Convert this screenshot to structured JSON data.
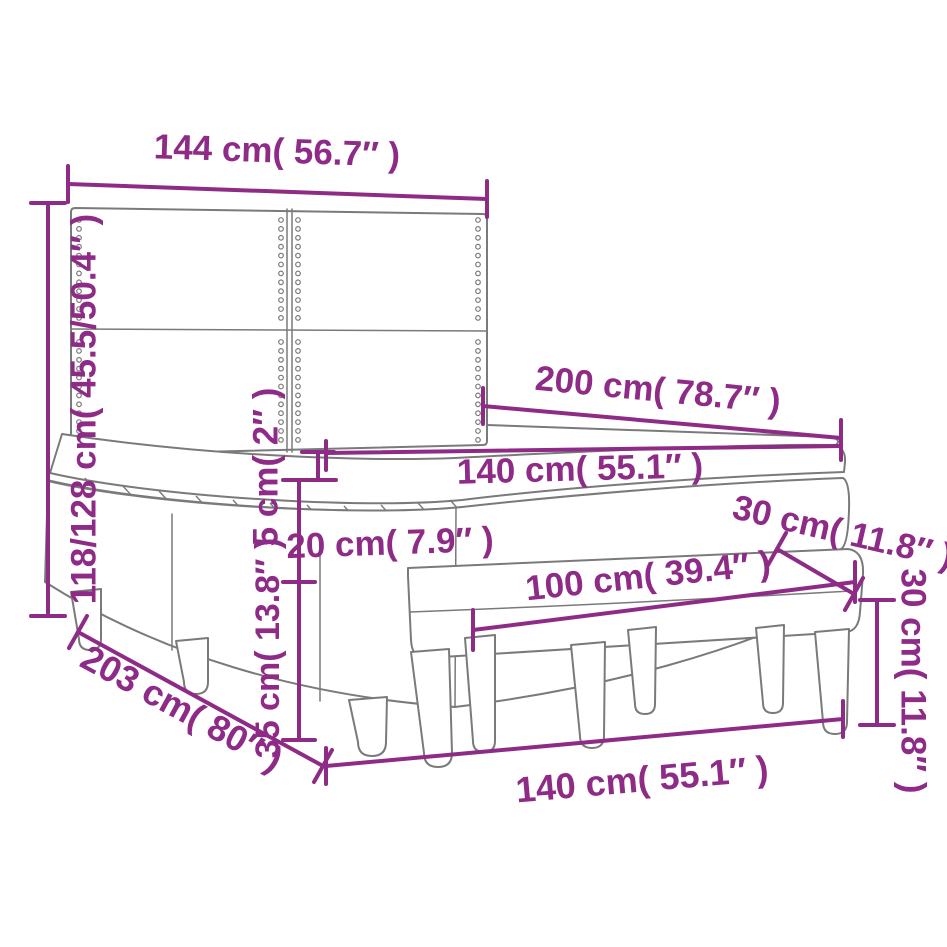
{
  "title": "Box spring bed with mattress and bench — dimension diagram",
  "colors": {
    "dimension_annotation": "#8e2b87",
    "outline": "#7a7a7a",
    "background": "#ffffff"
  },
  "labels": {
    "headboard_width": "144 cm( 56.7″ )",
    "bed_height": "118/128 cm( 45.5/50.4″ )",
    "bed_length": "200 cm( 78.7″ )",
    "mattress_width": "140 cm( 55.1″ )",
    "topper_height": "5 cm( 2″ )",
    "mattress_height": "20 cm( 7.9″ )",
    "base_height": "35 cm( 13.8″ )",
    "total_length": "203 cm( 80″ )",
    "bench_width": "100 cm( 39.4″ )",
    "bench_depth": "30 cm( 11.8″ )",
    "bench_height": "30 cm( 11.8″ )",
    "bed_width_floor": "140 cm( 55.1″ )"
  }
}
